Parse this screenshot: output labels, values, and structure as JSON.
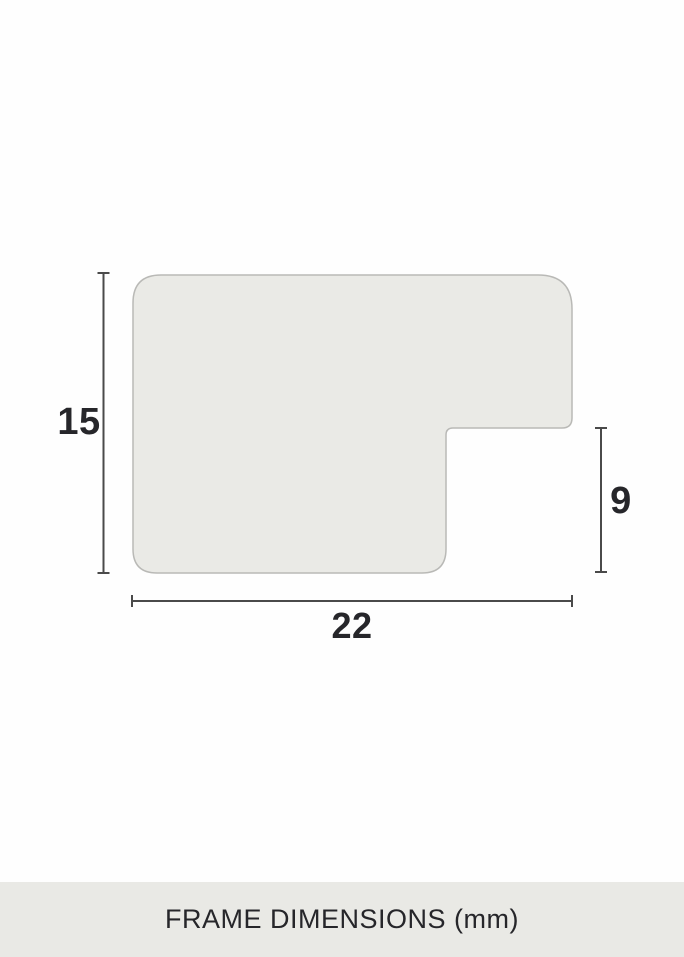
{
  "diagram": {
    "type": "frame-profile-cross-section",
    "dimensions": {
      "height_label": "15",
      "rabbet_label": "9",
      "width_label": "22"
    },
    "unit": "mm"
  },
  "footer": {
    "title": "FRAME DIMENSIONS (mm)"
  },
  "colors": {
    "background": "#fefefe",
    "profile_fill": "#eaeae6",
    "profile_stroke": "#b9b9b6",
    "dimension_line": "#4a4a4a",
    "footer_background": "#e9e9e5",
    "text": "#26262a"
  }
}
